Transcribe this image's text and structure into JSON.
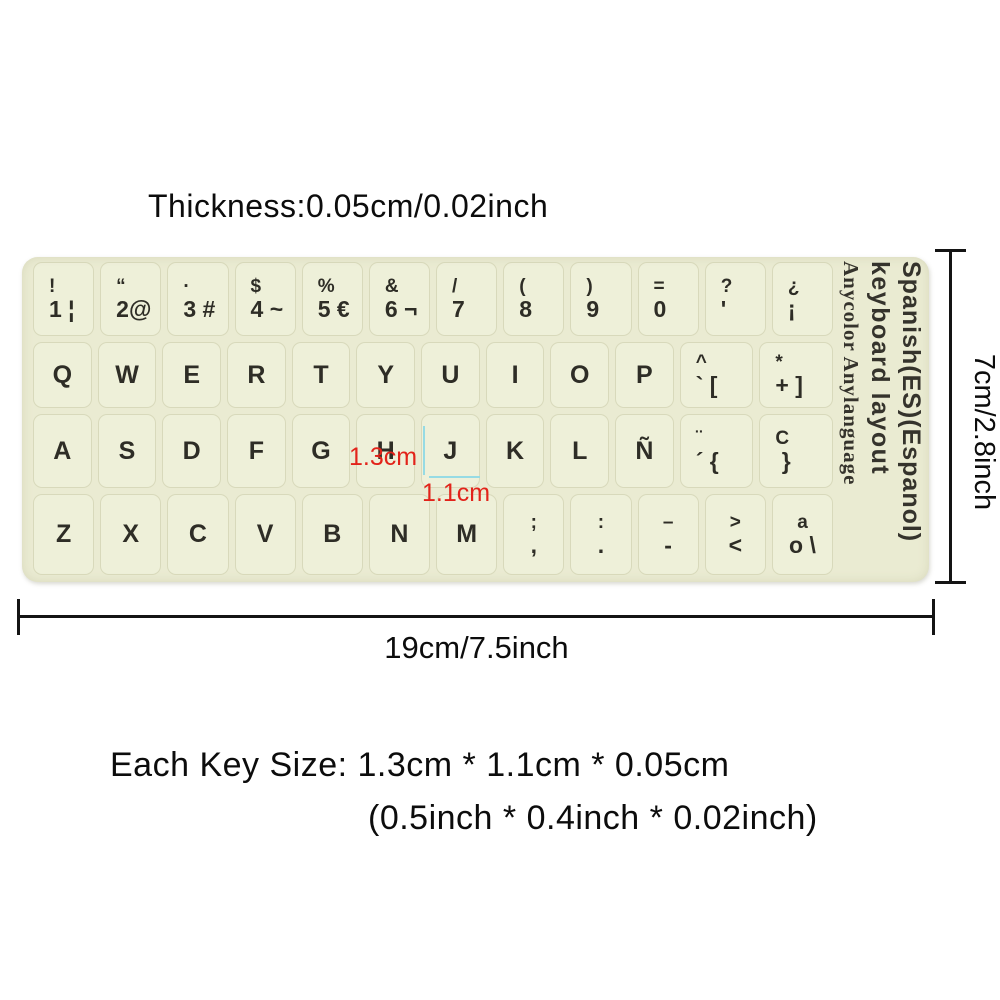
{
  "title": {
    "text": "Thickness:0.05cm/0.02inch"
  },
  "sticker": {
    "bg_color": "#eaebd2",
    "side_text": {
      "line1": "Spanish(ES)(Espanol)",
      "line2": "keyboard layout",
      "line3": "Anycolor Anylanguage"
    },
    "rows": [
      [
        {
          "t": "!",
          "b": "1 ¦"
        },
        {
          "t": "“",
          "b": "2@"
        },
        {
          "t": "·",
          "b": "3 #"
        },
        {
          "t": "$",
          "b": "4 ~"
        },
        {
          "t": "%",
          "b": "5 €"
        },
        {
          "t": "&",
          "b": "6 ¬"
        },
        {
          "t": "/",
          "b": "7"
        },
        {
          "t": "(",
          "b": "8"
        },
        {
          "t": ")",
          "b": "9"
        },
        {
          "t": "=",
          "b": "0"
        },
        {
          "t": "?",
          "b": "'"
        },
        {
          "t": "¿",
          "b": "¡"
        }
      ],
      [
        "Q",
        "W",
        "E",
        "R",
        "T",
        "Y",
        "U",
        "I",
        "O",
        "P",
        {
          "t": "^",
          "b": "` ["
        },
        {
          "t": "*",
          "b": "+ ]"
        }
      ],
      [
        "A",
        "S",
        "D",
        "F",
        "G",
        "H",
        "J",
        "K",
        "L",
        "Ñ",
        {
          "t": "¨",
          "b": "´ {"
        },
        {
          "t": "C",
          "b": " }"
        }
      ],
      [
        "Z",
        "X",
        "C",
        "V",
        "B",
        "N",
        "M",
        {
          "t": ";",
          "b": ","
        },
        {
          "t": ":",
          "b": "."
        },
        {
          "t": "–",
          "b": "-"
        },
        {
          "t": ">",
          "b": "<"
        },
        {
          "t": "a",
          "b": "o \\"
        }
      ]
    ]
  },
  "annotations": {
    "key_width": "1.3cm",
    "key_height": "1.1cm",
    "red_color": "#e2231a",
    "line_color": "#96dbe4"
  },
  "dimensions": {
    "height": "7cm/2.8inch",
    "width": "19cm/7.5inch"
  },
  "key_size": {
    "line1": "Each Key Size: 1.3cm * 1.1cm * 0.05cm",
    "line2": "(0.5inch * 0.4inch * 0.02inch)"
  }
}
